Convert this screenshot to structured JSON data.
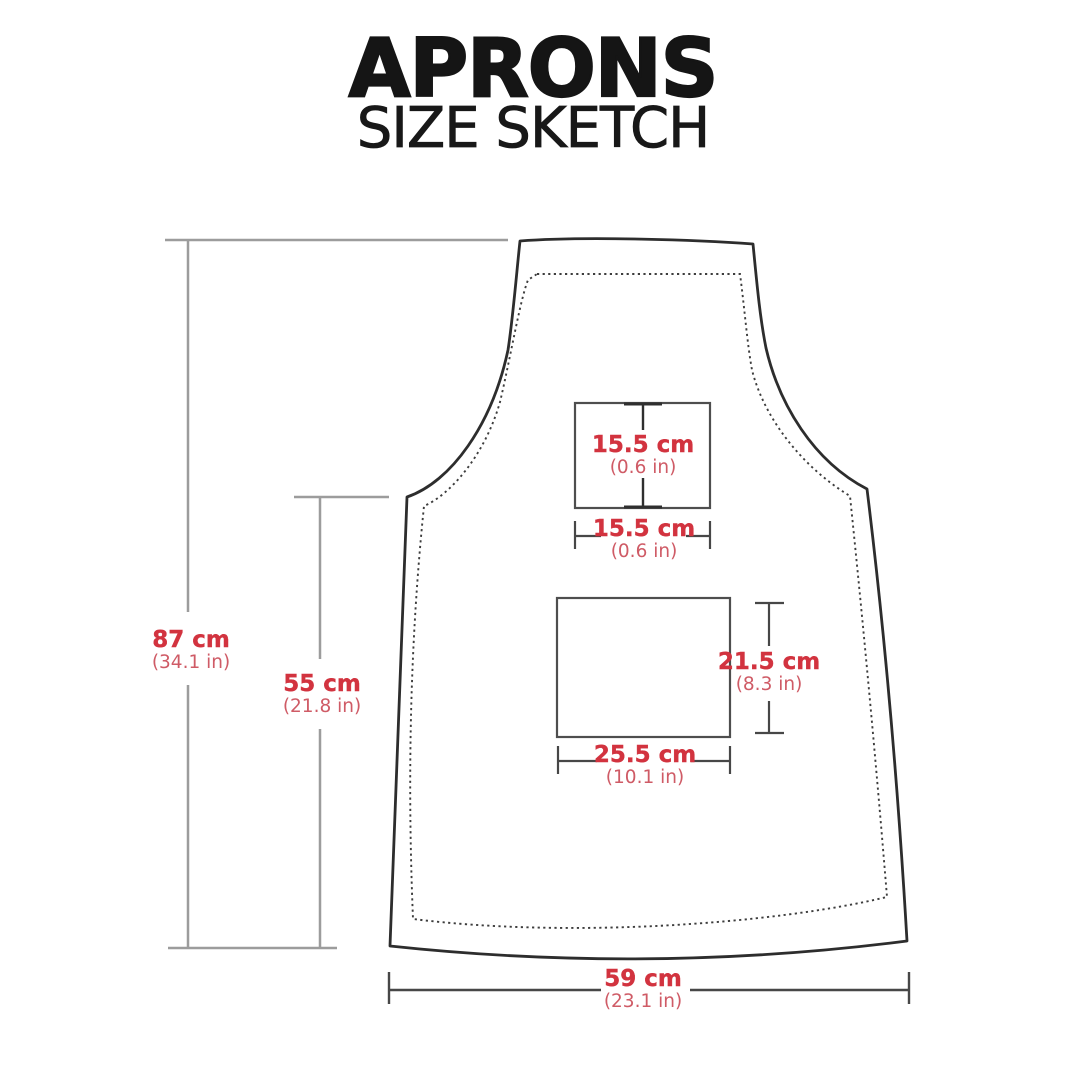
{
  "header": {
    "title": "APRONS",
    "subtitle": "SIZE SKETCH"
  },
  "measurements": {
    "total_height": {
      "metric": "87 cm",
      "imperial": "(34.1 in)"
    },
    "torso_height": {
      "metric": "55 cm",
      "imperial": "(21.8 in)"
    },
    "chest_pocket_height": {
      "metric": "15.5 cm",
      "imperial": "(0.6 in)"
    },
    "chest_pocket_width": {
      "metric": "15.5 cm",
      "imperial": "(0.6 in)"
    },
    "front_pocket_height": {
      "metric": "21.5 cm",
      "imperial": "(8.3 in)"
    },
    "front_pocket_width": {
      "metric": "25.5 cm",
      "imperial": "(10.1 in)"
    },
    "bottom_width": {
      "metric": "59 cm",
      "imperial": "(23.1 in)"
    }
  },
  "colors": {
    "accent": "#d2333f",
    "accent_light": "#cf5b66",
    "outline_dark": "#2d2d2d",
    "dimension_gray": "#9c9c9c"
  }
}
